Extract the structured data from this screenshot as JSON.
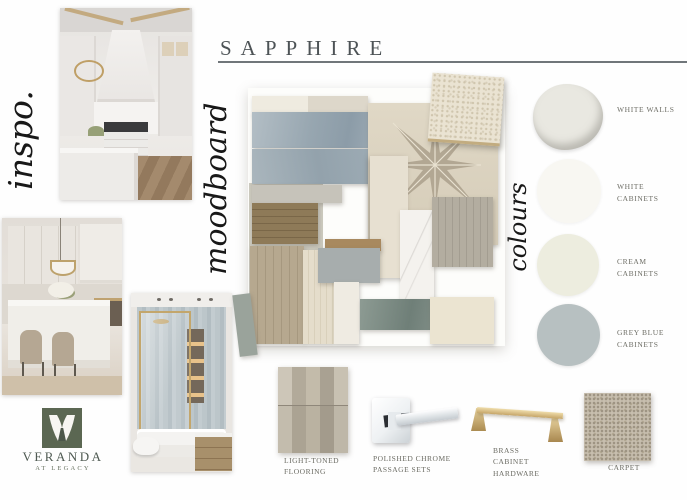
{
  "header": {
    "title": "SAPPHIRE"
  },
  "sections": {
    "inspo": "inspo.",
    "moodboard": "moodboard",
    "colours": "colours"
  },
  "palette": [
    {
      "label": "WHITE WALLS",
      "hex": "#e9e8e1"
    },
    {
      "label": "WHITE CABINETS",
      "hex": "#f8f7f2"
    },
    {
      "label": "CREAM CABINETS",
      "hex": "#ededdf"
    },
    {
      "label": "GREY BLUE CABINETS",
      "hex": "#b7c0c1"
    }
  ],
  "finishes": [
    {
      "label": "LIGHT-TONED FLOORING"
    },
    {
      "label": "POLISHED CHROME PASSAGE SETS"
    },
    {
      "label": "BRASS CABINET HARDWARE"
    },
    {
      "label": "CARPET"
    }
  ],
  "logo": {
    "brand": "VERANDA",
    "tagline": "AT LEGACY",
    "green": "#5b6752"
  },
  "accents": {
    "brass": "#c4a56b",
    "chrome": "#dfe3e6",
    "tile_blue": "#9fadb8",
    "star_tile_star": "#b2a793",
    "star_tile_bg": "#dcd3c0"
  },
  "moodboard_materials": [
    "cream subway tile",
    "grey-blue glazed subway tile",
    "star patterned cement tile",
    "pearl textured fabric",
    "stained oak wood",
    "light oak flooring",
    "cream travertine plank",
    "grey paint chip",
    "marble slab",
    "grey-washed wood",
    "sage ceramic tile",
    "cream field tile"
  ]
}
